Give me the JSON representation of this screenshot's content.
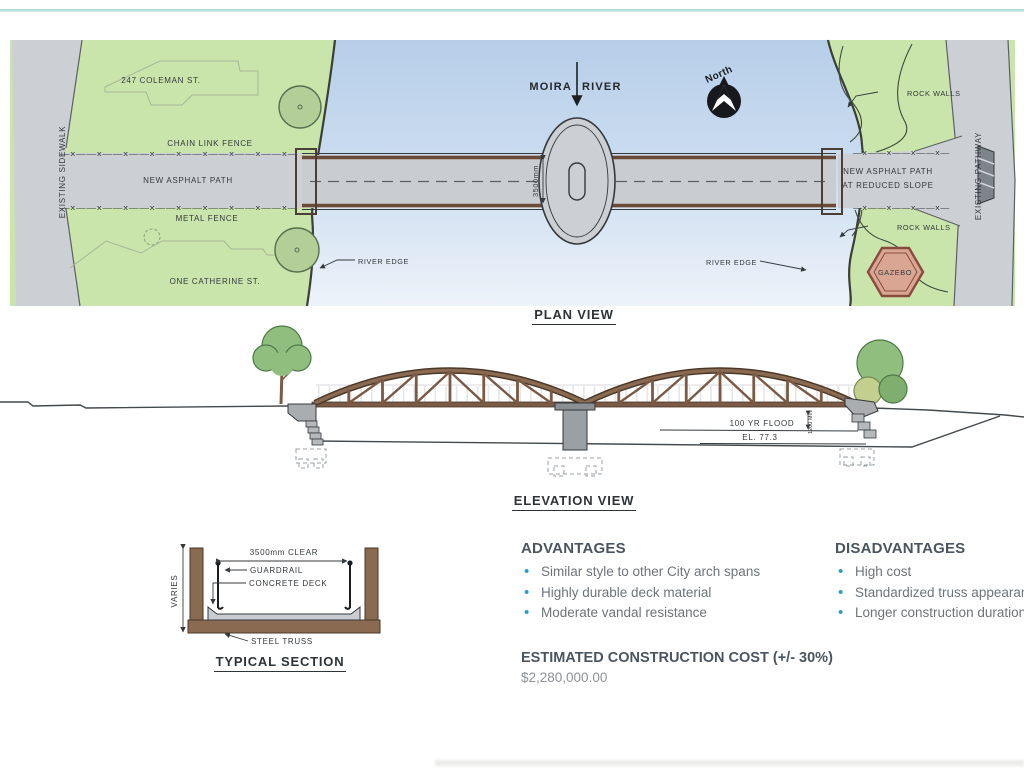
{
  "plan": {
    "title": "PLAN VIEW",
    "labels": {
      "coleman": "247 COLEMAN ST.",
      "catherine": "ONE CATHERINE ST.",
      "chain_fence": "CHAIN LINK FENCE",
      "metal_fence": "METAL FENCE",
      "asphalt_path": "NEW ASPHALT PATH",
      "reduced_1": "NEW ASPHALT PATH",
      "reduced_2": "AT REDUCED SLOPE",
      "existing_sidewalk": "EXISTING SIDEWALK",
      "existing_pathway": "EXISTING PATHWAY",
      "rock_walls_top": "ROCK WALLS",
      "rock_walls_bottom": "ROCK WALLS",
      "river_edge_left": "RIVER EDGE",
      "river_edge_right": "RIVER EDGE",
      "moira_1": "MOIRA",
      "moira_2": "RIVER",
      "north": "North",
      "gazebo": "GAZEBO",
      "deck_width": "3500mm",
      "fence_long": "—x——x——x——x——x——x——x——x——x—",
      "fence_short": "—x——x——x——x—"
    }
  },
  "elevation": {
    "title": "ELEVATION VIEW",
    "labels": {
      "flood": "100 YR FLOOD",
      "flood_el": "EL. 77.3",
      "min_dim": "1200 MIN"
    }
  },
  "section": {
    "title": "TYPICAL SECTION",
    "labels": {
      "clear": "3500mm CLEAR",
      "guardrail": "GUARDRAIL",
      "deck": "CONCRETE DECK",
      "truss": "STEEL TRUSS",
      "varies": "VARIES"
    }
  },
  "summary": {
    "advantages": {
      "heading": "ADVANTAGES",
      "items": [
        "Similar style to other City arch spans",
        "Highly durable deck material",
        "Moderate vandal resistance"
      ]
    },
    "disadvantages": {
      "heading": "DISADVANTAGES",
      "items": [
        "High cost",
        "Standardized truss appearance",
        "Longer construction duration"
      ]
    },
    "cost": {
      "heading": "ESTIMATED CONSTRUCTION COST (+/- 30%)",
      "value": "$2,280,000.00"
    }
  },
  "colors": {
    "accent_teal": "#a5d4d0",
    "bullet_blue": "#2a9dc7",
    "truss_brown": "#7a5a44",
    "grass_green": "#c9e5ab",
    "river_blue": "#b7cee9",
    "gazebo_fill": "#d9a694"
  }
}
